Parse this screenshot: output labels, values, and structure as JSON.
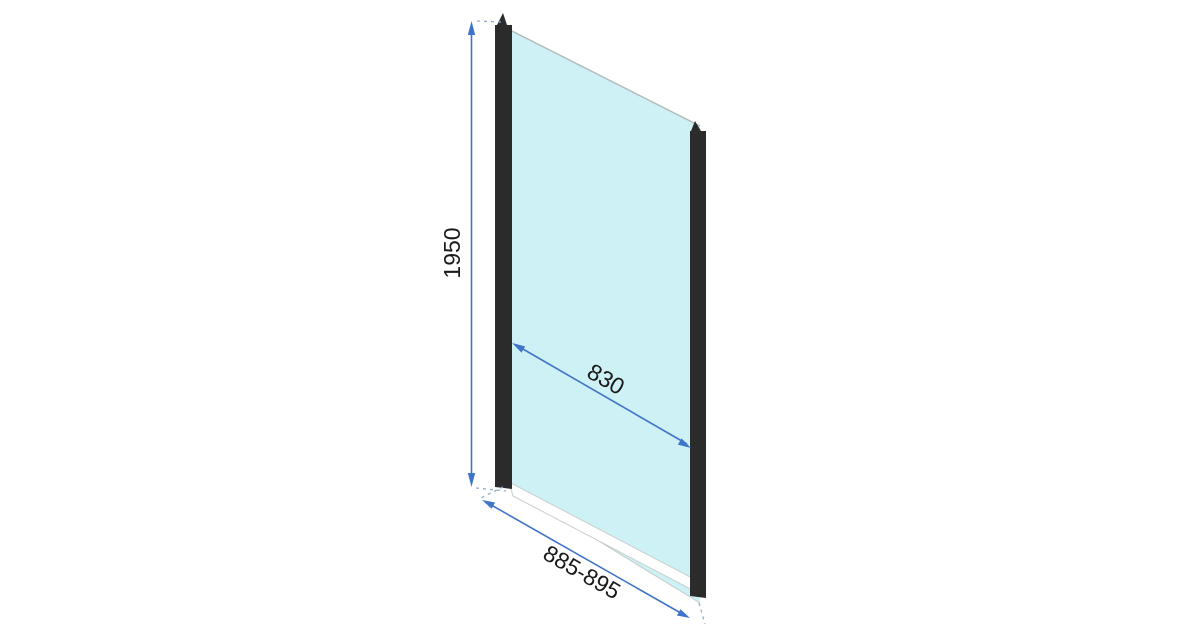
{
  "drawing": {
    "title": "Shower glass panel technical drawing",
    "labels": {
      "height": "1950",
      "glass_width": "830",
      "installation_width": "885-895"
    },
    "colors": {
      "background": "#ffffff",
      "glass": "#cdf1f4",
      "profile": "#2b2b2b",
      "dimension": "#3f74c9",
      "extension": "#93accf",
      "glass_edge": "#b2baba",
      "text": "#1a1a1a"
    }
  }
}
